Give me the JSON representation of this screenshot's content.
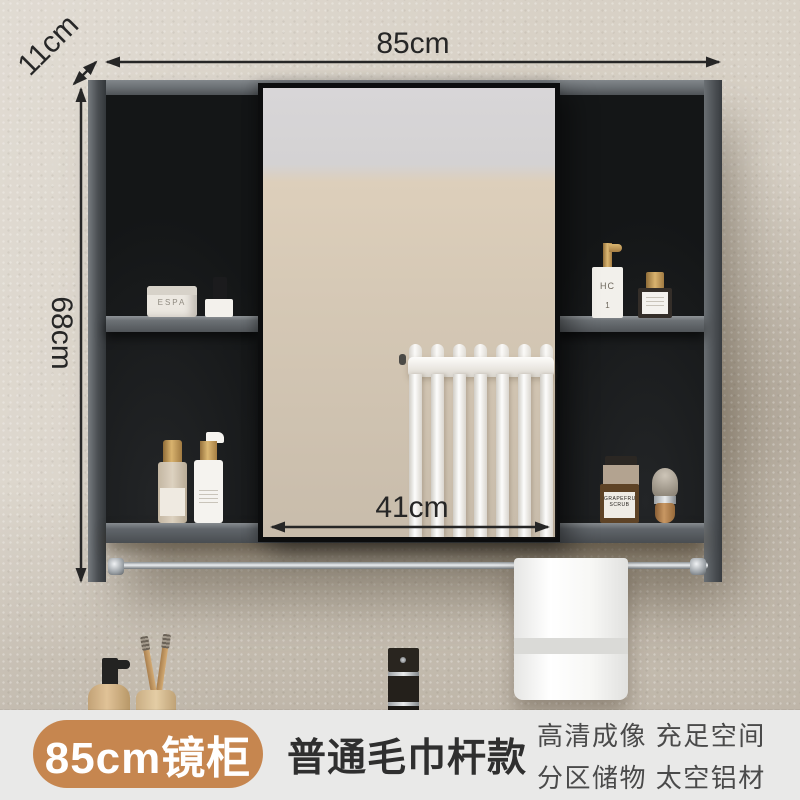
{
  "annotations": {
    "width": "85cm",
    "depth": "11cm",
    "height": "68cm",
    "mirror_width": "41cm"
  },
  "info_bar": {
    "badge": "85cm镜柜",
    "title": "普通毛巾杆款",
    "features_line1": "高清成像 充足空间",
    "features_line2": "分区储物 太空铝材"
  },
  "products": {
    "cream_jar_label": "ESPA",
    "pump_bottle_label": "HC",
    "pump_bottle_number": "1",
    "amber_jar_label": "GRAPEFRUIT SCRUB"
  },
  "colors": {
    "badge_bg": "#c6864f",
    "info_bar_bg": "#e9e9e8",
    "wall": "#d8d1c6",
    "cabinet_frame": "#54585c",
    "cabinet_interior": "#191b1d",
    "dimension_line": "#262626"
  }
}
